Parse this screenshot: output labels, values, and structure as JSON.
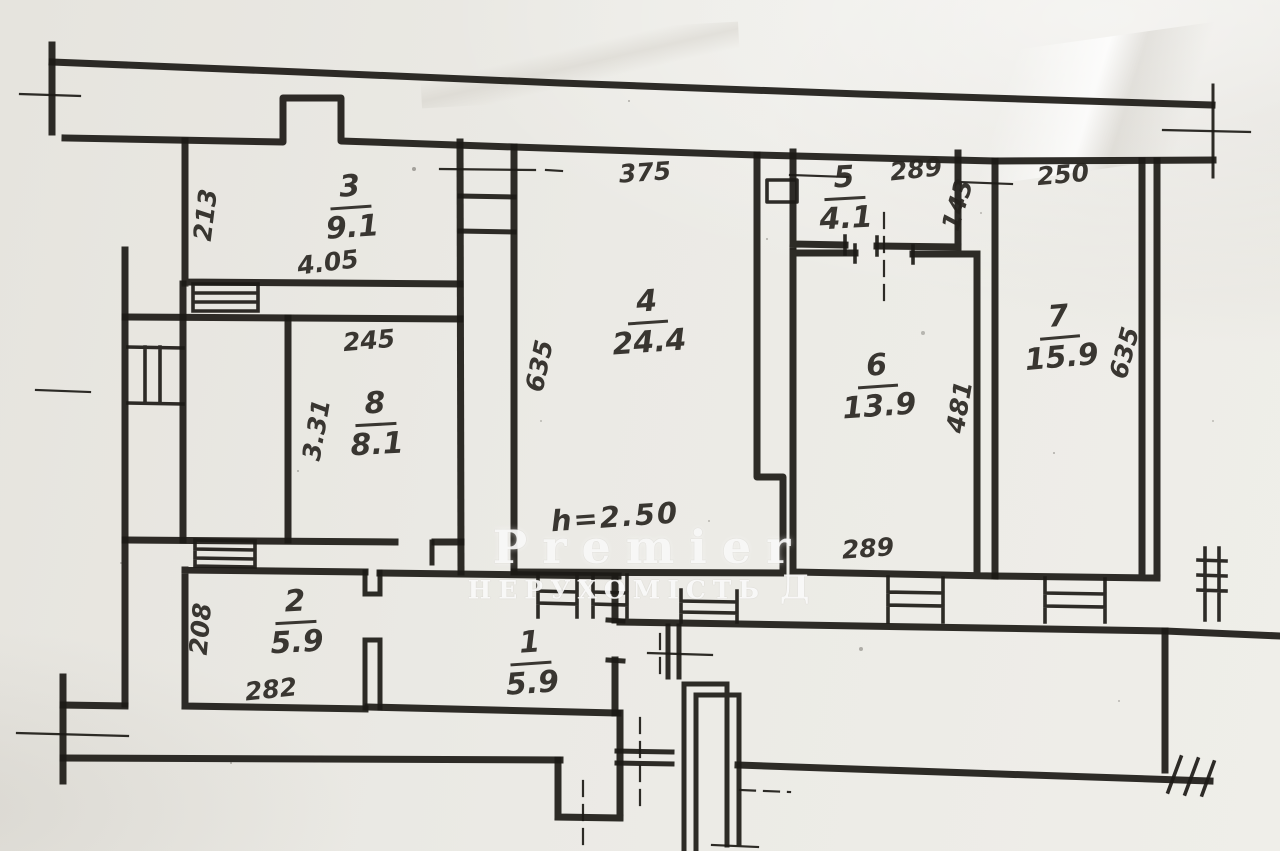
{
  "watermark": {
    "brand": "Premier",
    "tagline": "НЕРУХОМІСТЬ",
    "tagline_suffix": "Д"
  },
  "ceiling_note": "h=2.50",
  "rooms": {
    "r1": {
      "number": "1",
      "area": "5.9"
    },
    "r2": {
      "number": "2",
      "area": "5.9",
      "dim_side": "208",
      "dim_bottom": "282"
    },
    "r3": {
      "number": "3",
      "area": "9.1",
      "dim_width": "4.05",
      "dim_side": "213"
    },
    "r4": {
      "number": "4",
      "area": "24.4",
      "dim_top": "375",
      "dim_side": "635"
    },
    "r5": {
      "number": "5",
      "area": "4.1",
      "dim_top": "289",
      "dim_side": "143"
    },
    "r6": {
      "number": "6",
      "area": "13.9",
      "dim_side": "481",
      "dim_bottom": "289"
    },
    "r7": {
      "number": "7",
      "area": "15.9",
      "dim_top": "250",
      "dim_side": "635"
    },
    "r8": {
      "number": "8",
      "area": "8.1",
      "dim_top": "245",
      "dim_side": "3.31"
    }
  }
}
